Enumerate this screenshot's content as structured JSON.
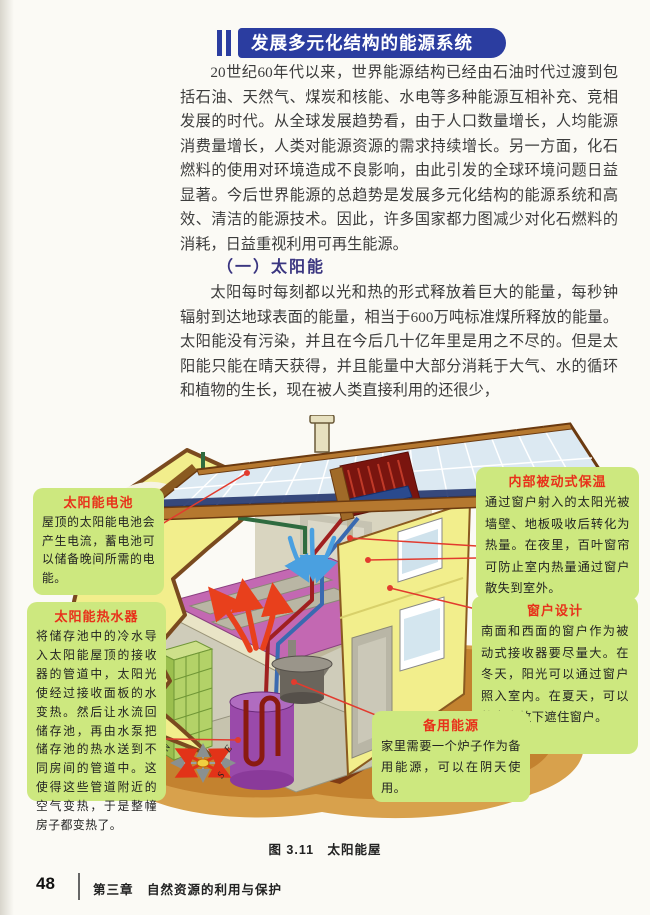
{
  "header": {
    "title": "发展多元化结构的能源系统"
  },
  "content": {
    "paragraph1": "20世纪60年代以来，世界能源结构已经由石油时代过渡到包括石油、天然气、煤炭和核能、水电等多种能源互相补充、竞相发展的时代。从全球发展趋势看，由于人口数量增长，人均能源消费量增长，人类对能源资源的需求持续增长。另一方面，化石燃料的使用对环境造成不良影响，由此引发的全球环境问题日益显著。今后世界能源的总趋势是发展多元化结构的能源系统和高效、清洁的能源技术。因此，许多国家都力图减少对化石燃料的消耗，日益重视利用可再生能源。",
    "section_heading": "（一）太阳能",
    "paragraph2": "太阳每时每刻都以光和热的形式释放着巨大的能量，每秒钟辐射到达地球表面的能量，相当于600万吨标准煤所释放的能量。太阳能没有污染，并且在今后几十亿年里是用之不尽的。但是太阳能只能在晴天获得，并且能量中大部分消耗于大气、水的循环和植物的生长，现在被人类直接利用的还很少，"
  },
  "figure": {
    "caption": "图 3.11　太阳能屋",
    "callouts": [
      {
        "title": "太阳能电池",
        "body": "屋顶的太阳能电池会产生电流，蓄电池可以储备晚间所需的电能。"
      },
      {
        "title": "太阳能热水器",
        "body": "将储存池中的冷水导入太阳能屋顶的接收器的管道中，太阳光使经过接收面板的水变热。然后让水流回储存池，再由水泵把储存池的热水送到不同房间的管道中。这使得这些管道附近的空气变热，于是整幢房子都变热了。"
      },
      {
        "title": "内部被动式保温",
        "body": "通过窗户射入的太阳光被墙壁、地板吸收后转化为热量。在夜里，百叶窗帘可防止室内热量通过窗户散失到室外。"
      },
      {
        "title": "窗户设计",
        "body": "南面和西面的窗户作为被动式接收器要尽量大。在冬天，阳光可以通过窗户照入室内。在夏天，可以将窗帘放下遮住窗户。"
      },
      {
        "title": "备用能源",
        "body": "家里需要一个炉子作为备用能源，可以在阴天使用。"
      }
    ],
    "compass": {
      "n": "N",
      "e": "E",
      "s": "S",
      "w": "W"
    }
  },
  "footer": {
    "page_number": "48",
    "chapter": "第三章　自然资源的利用与保护"
  },
  "colors": {
    "header_blue": "#2b3da0",
    "heading_purple": "#3a3580",
    "callout_green": "#cde87f",
    "callout_title_red": "#e8311a",
    "leader_red": "#e23b2e",
    "house_yellow": "#f2ee8c",
    "roof_brown": "#b5782f",
    "panel_blue": "#dce9f2",
    "ground_brown": "#c3822f",
    "floor_magenta": "#c368b2"
  }
}
